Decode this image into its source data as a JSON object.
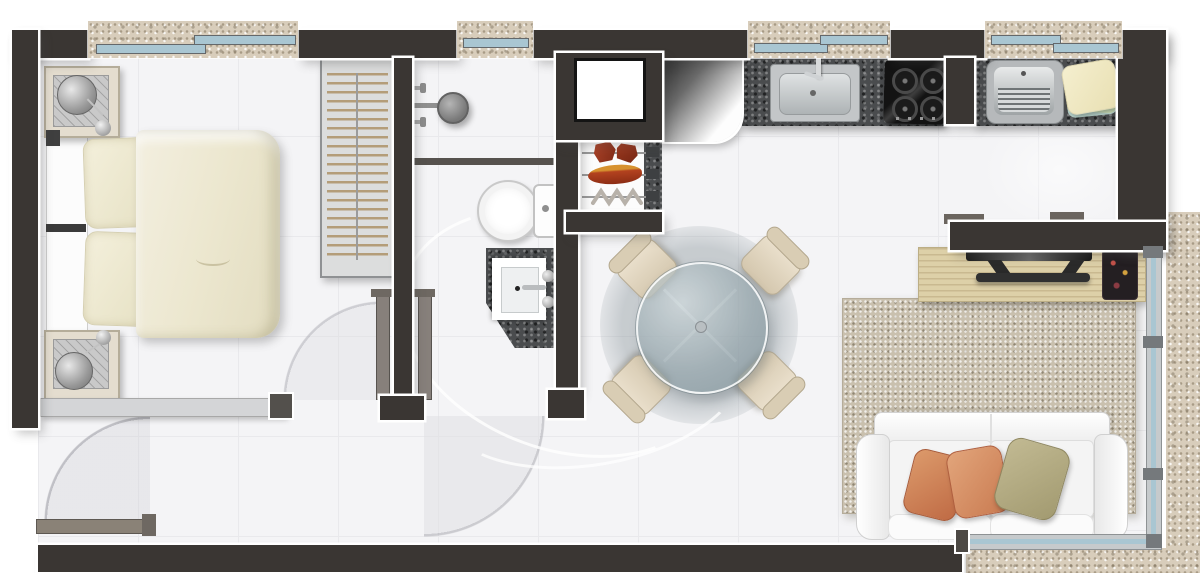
{
  "title": "studio-apartment-floor-plan",
  "palette": {
    "wall": "#3a3633",
    "wall_outline": "#ffffff",
    "floor": "#f4f4f6",
    "granite_dark": "#4a4c4e",
    "granite_beige": "#d8cdbb",
    "window_glass": "#a9c6d2",
    "wood_rack": "#ddd0a8",
    "rug": "#c9c0ae",
    "duvet": "#eeead6",
    "pillow_orange": "#cd7a4e",
    "pillow_olive": "#b0a87e",
    "chair": "#e0d5c0"
  },
  "rooms": {
    "bedroom": {
      "label": "bedroom",
      "items": [
        "double-bed",
        "pillow",
        "pillow",
        "nightstand",
        "table-lamp",
        "nightstand",
        "table-lamp",
        "wardrobe-hangers",
        "sliding-door-panel",
        "window-double"
      ]
    },
    "bathroom": {
      "label": "bathroom",
      "items": [
        "shower-head",
        "shower-valves",
        "shower-partition",
        "toilet",
        "vanity-granite",
        "square-basin",
        "faucet",
        "window-single",
        "door-swing"
      ]
    },
    "kitchen": {
      "label": "kitchen",
      "items": [
        "granite-counter",
        "stainless-sink",
        "gas-cooktop-4-burners",
        "refrigerator",
        "duct-shaft",
        "grill-niche-skewers",
        "window-double"
      ]
    },
    "laundry": {
      "label": "laundry",
      "items": [
        "granite-counter",
        "ribbed-laundry-tub",
        "folded-towels",
        "window-double"
      ]
    },
    "dining": {
      "label": "dining",
      "items": [
        "round-glass-table",
        "chair",
        "chair",
        "chair",
        "chair"
      ]
    },
    "living": {
      "label": "living-room",
      "items": [
        "area-rug",
        "two-seat-sofa",
        "cushion-orange",
        "cushion-orange",
        "cushion-olive",
        "tv-rack",
        "flat-tv",
        "mini-console"
      ]
    },
    "balcony": {
      "label": "balcony",
      "items": [
        "glass-railing-vertical",
        "glass-railing-horizontal",
        "granite-floor"
      ]
    },
    "entry": {
      "label": "entry",
      "items": [
        "entry-door-leaf",
        "door-swing-arc"
      ]
    }
  }
}
